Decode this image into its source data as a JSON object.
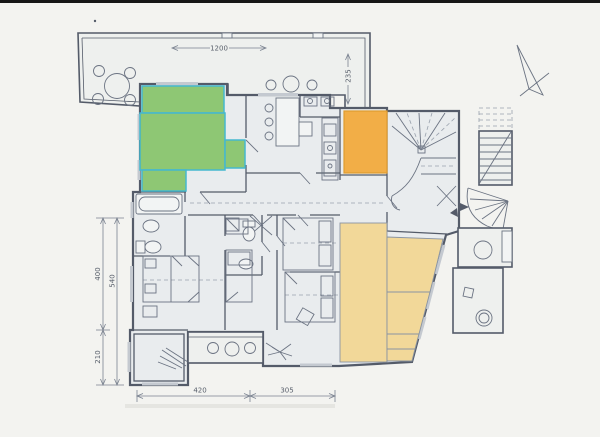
{
  "document": {
    "type": "architectural-floor-plan"
  },
  "dimensions": {
    "terrace_width": "1200",
    "terrace_depth": "235",
    "left_upper": "400",
    "left_full": "540",
    "left_lower": "210",
    "bottom_left": "420",
    "bottom_right": "305"
  },
  "colors": {
    "paper": "#f3f3f0",
    "top_bar": "#161616",
    "line": "#545b69",
    "furn": "#6b7382",
    "dash": "#99a1ad",
    "dim": "#7a8290",
    "dim_text": "#59606c",
    "room_fill": "#e9ecee",
    "terrace_fill": "#eef0ee",
    "window_gray": "#c4c9d0",
    "highlight_green": "#86c46a",
    "highlight_orange": "#f2ab3d",
    "highlight_yellow": "#f2d794",
    "highlight_border": "#45b8cf",
    "orange_border": "#df9c30",
    "yellow_border": "#8a94a2"
  }
}
